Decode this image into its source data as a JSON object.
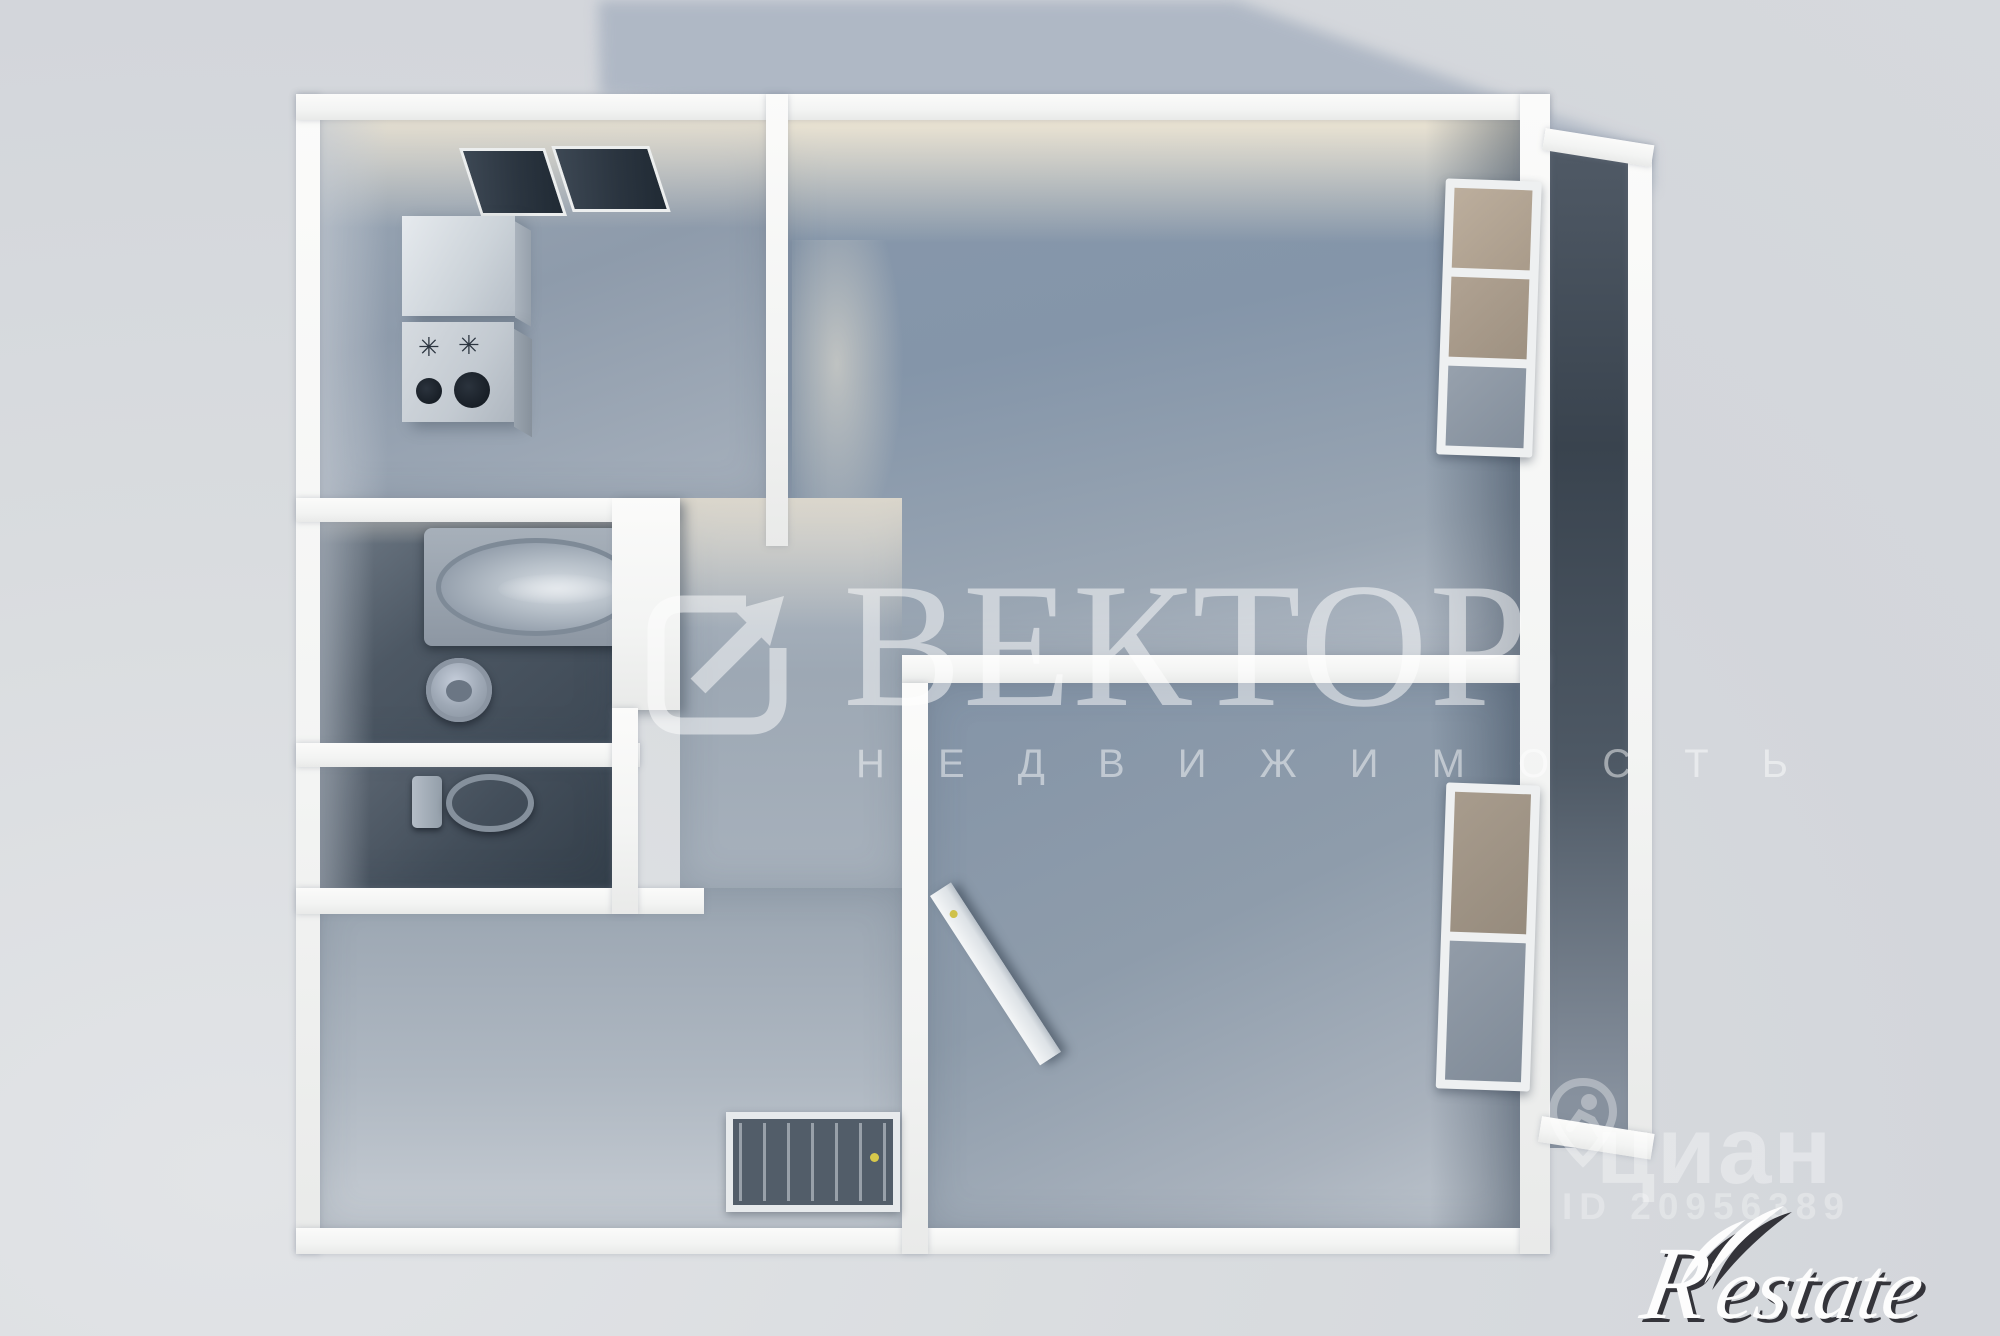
{
  "watermarks": {
    "vektor": {
      "title": "ВЕКТОР",
      "subtitle": "Н Е Д В И Ж И М О С Т Ь",
      "icon": "arrow-out-of-square",
      "color": "#ffffff"
    },
    "cian": {
      "name": "циан",
      "listing_id": "ID 20956389",
      "icon": "location-pin-person",
      "color": "#ffffff"
    },
    "restate": {
      "name": "estate",
      "initial": "R",
      "color": "#ffffff"
    }
  },
  "colors": {
    "background": "#d6d9dd",
    "cast_shadow": "#a8b2c1",
    "wall_white": "#f6f7f5",
    "room_wall_blue": "#8a9aac",
    "wet_room_floor": "#46515d",
    "ceiling_glow": "#f8eed8",
    "window_pane_dark": "#2e3843",
    "window_pane_tan": "#b0a393",
    "door_handle_yellow": "#d8c94b"
  }
}
